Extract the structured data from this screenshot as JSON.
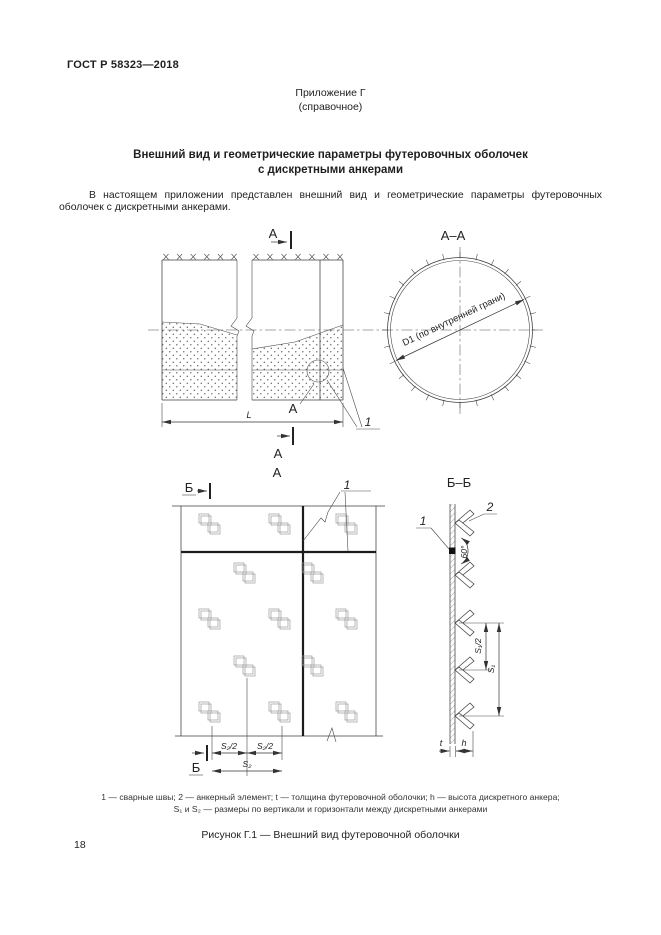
{
  "page": {
    "doc_number": "ГОСТ Р 58323—2018",
    "appendix": "Приложение Г",
    "appendix_type": "(справочное)",
    "title_line1": "Внешний вид и геометрические параметры футеровочных оболочек",
    "title_line2": "с дискретными анкерами",
    "body_text": "В настоящем приложении представлен внешний вид и геометрические параметры футеровочных оболочек с дискретными анкерами.",
    "page_number": "18"
  },
  "figure": {
    "labels": {
      "a": "А",
      "aa": "А–А",
      "b": "Б",
      "bb": "Б–Б",
      "callout_1": "1",
      "callout_2": "2",
      "dim_L": "L",
      "dim_D1": "D1 (по внутренней грани)",
      "dim_s2_half": "S₂/2",
      "dim_s2": "S₂",
      "dim_s1_half": "S₁/2",
      "dim_s1": "S₁",
      "dim_t": "t",
      "dim_h": "h",
      "angle_60": "60°"
    },
    "legend_line1": "1 — сварные швы; 2 — анкерный элемент; t — толщина футеровочной оболочки; h — высота дискретного анкера;",
    "legend_line2": "S₁ и S₂ — размеры по вертикали и горизонтали между дискретными анкерами",
    "caption": "Рисунок Г.1 — Внешний вид футеровочной оболочки"
  }
}
